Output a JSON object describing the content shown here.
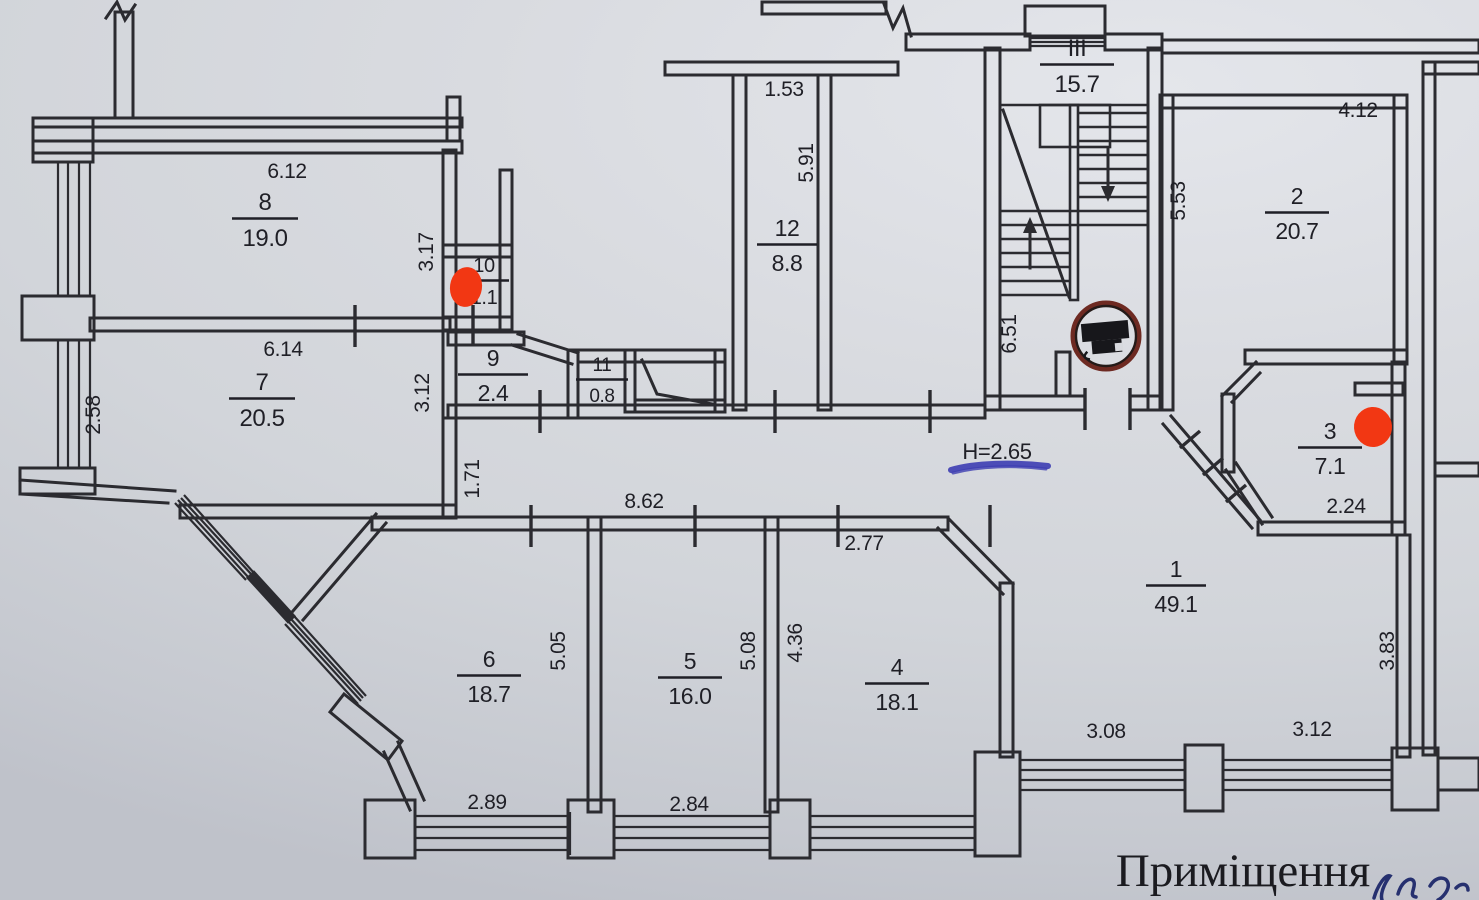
{
  "plan": {
    "caption": "Приміщення",
    "ceiling_height_note": "H=2.65",
    "rooms": [
      {
        "id": "8",
        "area": "19.0"
      },
      {
        "id": "7",
        "area": "20.5"
      },
      {
        "id": "10",
        "area": "1.1"
      },
      {
        "id": "9",
        "area": "2.4"
      },
      {
        "id": "11",
        "area": "0.8"
      },
      {
        "id": "12",
        "area": "8.8"
      },
      {
        "id": "III",
        "area": "15.7"
      },
      {
        "id": "2",
        "area": "20.7"
      },
      {
        "id": "3",
        "area": "7.1"
      },
      {
        "id": "1",
        "area": "49.1"
      },
      {
        "id": "6",
        "area": "18.7"
      },
      {
        "id": "5",
        "area": "16.0"
      },
      {
        "id": "4",
        "area": "18.1"
      }
    ],
    "dimensions": [
      {
        "text": "6.12"
      },
      {
        "text": "3.17"
      },
      {
        "text": "6.14"
      },
      {
        "text": "2.58"
      },
      {
        "text": "3.12"
      },
      {
        "text": "1.71"
      },
      {
        "text": "1.53"
      },
      {
        "text": "5.91"
      },
      {
        "text": "5.53"
      },
      {
        "text": "6.51"
      },
      {
        "text": "4.12"
      },
      {
        "text": "2.24"
      },
      {
        "text": "8.62"
      },
      {
        "text": "2.77"
      },
      {
        "text": "5.05"
      },
      {
        "text": "5.08"
      },
      {
        "text": "4.36"
      },
      {
        "text": "2.89"
      },
      {
        "text": "2.84"
      },
      {
        "text": "3.08"
      },
      {
        "text": "3.12"
      },
      {
        "text": "3.83"
      }
    ],
    "symbols": {
      "stair_arrows": "up and down flight arrows",
      "red_markers_count": 2,
      "chute_circle": "circular refuse-chute symbol at stair landing"
    },
    "colors": {
      "paper": "#d7d9de",
      "line": "#2b2b30",
      "red_marker": "#f23713",
      "ink": "#3d3db2"
    }
  }
}
